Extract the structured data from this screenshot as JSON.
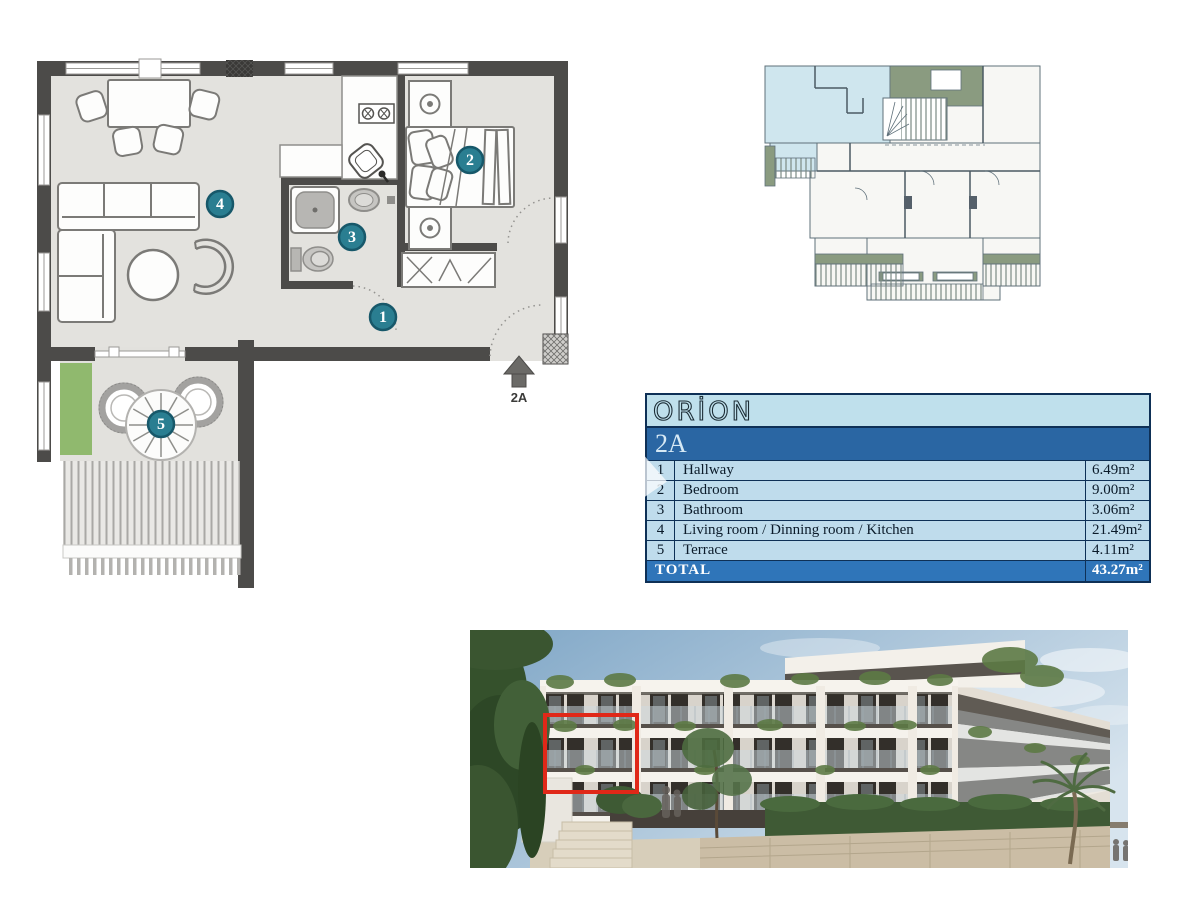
{
  "floor_plan": {
    "badges": [
      {
        "num": "1",
        "room": "Hallway"
      },
      {
        "num": "2",
        "room": "Bedroom"
      },
      {
        "num": "3",
        "room": "Bathroom"
      },
      {
        "num": "4",
        "room": "Living room / Dinning room / Kitchen"
      },
      {
        "num": "5",
        "room": "Terrace"
      }
    ],
    "entrance_label": "2A"
  },
  "key_plan": {
    "highlighted_unit": "2A"
  },
  "info_table": {
    "brand": "ORİON",
    "unit": "2A",
    "rows": [
      {
        "num": "1",
        "name": "Hallway",
        "area": "6.49m²"
      },
      {
        "num": "2",
        "name": "Bedroom",
        "area": "9.00m²"
      },
      {
        "num": "3",
        "name": "Bathroom",
        "area": "3.06m²"
      },
      {
        "num": "4",
        "name": "Living room / Dinning room / Kitchen",
        "area": "21.49m²"
      },
      {
        "num": "5",
        "name": "Terrace",
        "area": "4.11m²"
      }
    ],
    "total_label": "TOTAL",
    "total_area": "43.27m²"
  },
  "colors": {
    "badge_teal": "#2a7e91",
    "wall_charcoal": "#4c4b49",
    "planter_green": "#90b96e",
    "table_light_blue": "#bfdcec",
    "table_header_blue": "#2a66a3",
    "table_total_blue": "#2f75b9",
    "table_border_navy": "#0e3056",
    "keyplan_highlight_blue": "#cfe6ee",
    "keyplan_green": "#8a9b80",
    "unit_outline_red": "#e02818"
  }
}
